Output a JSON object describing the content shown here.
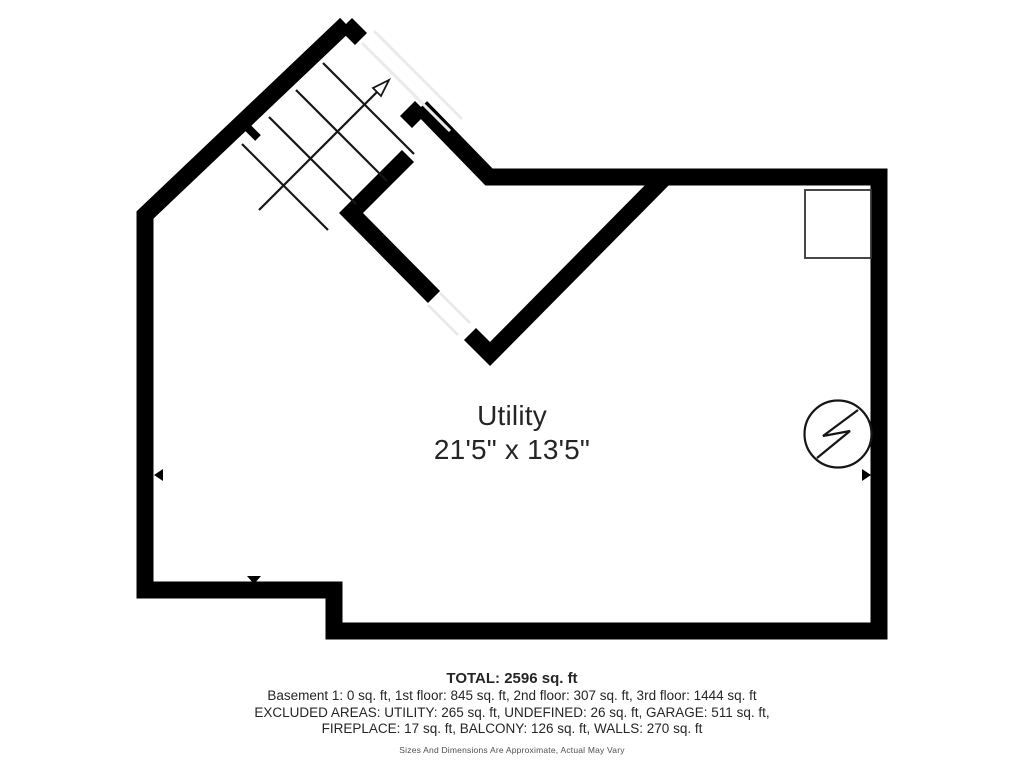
{
  "floor_plan": {
    "room_label": {
      "name": "Utility",
      "dimensions": "21'5\" x 13'5\""
    },
    "stairs": {
      "direction": "up"
    },
    "symbols": {
      "electrical_panel": "circle-lightning-bolt",
      "fixture_box": "square-outline"
    },
    "colors": {
      "wall": "#000000",
      "text": "#252525",
      "opening_line": "#ebebeb",
      "background": "#ffffff"
    }
  },
  "summary": {
    "total": "TOTAL: 2596 sq. ft",
    "floors": "Basement 1: 0 sq. ft, 1st floor: 845 sq. ft, 2nd floor: 307 sq. ft, 3rd floor: 1444 sq. ft",
    "excluded_line1": "EXCLUDED AREAS: UTILITY: 265 sq. ft, UNDEFINED: 26 sq. ft, GARAGE: 511 sq. ft,",
    "excluded_line2": "FIREPLACE: 17 sq. ft, BALCONY: 126 sq. ft, WALLS: 270 sq. ft",
    "disclaimer": "Sizes And Dimensions Are Approximate, Actual May Vary"
  }
}
